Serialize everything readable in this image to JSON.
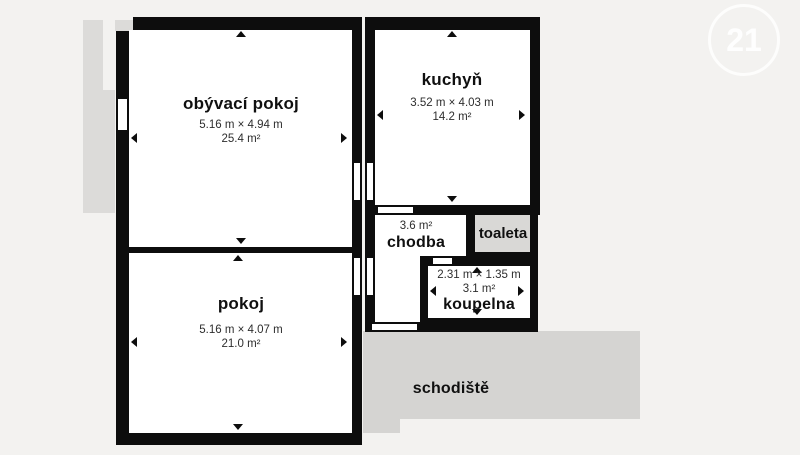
{
  "watermark": {
    "label": "21"
  },
  "rooms": {
    "obyvaci_pokoj": {
      "name": "obývací pokoj",
      "dimensions": "5.16 m × 4.94 m",
      "area": "25.4 m²"
    },
    "kuchyn": {
      "name": "kuchyň",
      "dimensions": "3.52 m × 4.03 m",
      "area": "14.2 m²"
    },
    "chodba": {
      "name": "chodba",
      "area": "3.6 m²"
    },
    "toaleta": {
      "name": "toaleta"
    },
    "koupelna": {
      "name": "koupelna",
      "dimensions": "2.31 m × 1.35 m",
      "area": "3.1 m²"
    },
    "pokoj": {
      "name": "pokoj",
      "dimensions": "5.16 m × 4.07 m",
      "area": "21.0 m²"
    },
    "schodiste": {
      "name": "schodiště"
    }
  },
  "colors": {
    "background": "#f3f2f0",
    "wall": "#0d0d0d",
    "room_fill": "#ffffff",
    "exterior_gray": "#dcdbd9",
    "stairs_gray": "#d5d4d2",
    "toilet_gray": "#d9d8d6",
    "text": "#111111"
  }
}
